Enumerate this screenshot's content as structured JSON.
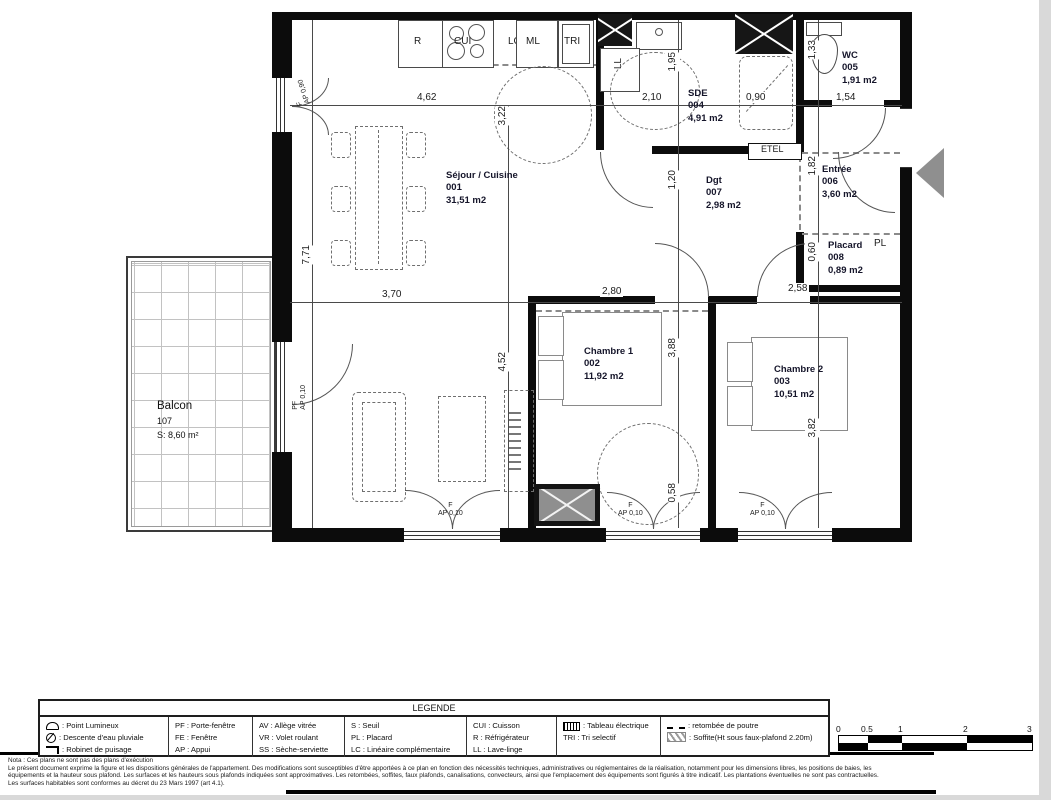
{
  "rooms": {
    "sejour": {
      "name": "Séjour / Cuisine",
      "num": "001",
      "area": "31,51 m2"
    },
    "chambre1": {
      "name": "Chambre 1",
      "num": "002",
      "area": "11,92 m2"
    },
    "chambre2": {
      "name": "Chambre 2",
      "num": "003",
      "area": "10,51 m2"
    },
    "sde": {
      "name": "SDE",
      "num": "004",
      "area": "4,91 m2"
    },
    "wc": {
      "name": "WC",
      "num": "005",
      "area": "1,91 m2"
    },
    "entree": {
      "name": "Entrée",
      "num": "006",
      "area": "3,60 m2"
    },
    "dgt": {
      "name": "Dgt",
      "num": "007",
      "area": "2,98 m2"
    },
    "placard": {
      "name": "Placard",
      "num": "008",
      "area": "0,89 m2"
    },
    "balcon": {
      "name": "Balcon",
      "num": "107",
      "area": "S: 8,60 m²"
    }
  },
  "appliances": {
    "r": "R",
    "cui": "CUI",
    "lc": "LC",
    "ml": "ML",
    "tri": "TRI",
    "ll": "LL"
  },
  "labels": {
    "etel": "ETEL",
    "pl": "PL"
  },
  "openings": {
    "f": "F",
    "pf": "PF",
    "ap010": "AP 0,10",
    "ap090": "AP 0,90"
  },
  "dims": {
    "sej_w_top": "4,62",
    "sej_h_top": "3,22",
    "left_h": "7,71",
    "sej_w_bot": "3,70",
    "sej_h_bot": "4,52",
    "sde_w": "2,10",
    "sde_h": "1,95",
    "shower_w": "0,90",
    "wc_h": "1,33",
    "wc_w": "1,54",
    "dgt_h": "1,20",
    "entree_h": "1,82",
    "placard_h": "0,60",
    "ch1_w": "2,80",
    "ch1_h": "3,88",
    "ch2_w": "2,58",
    "ch2_h": "3,82",
    "win_h": "0,58"
  },
  "legend": {
    "title": "LEGENDE",
    "col1": [
      {
        "text": ": Point Lumineux"
      },
      {
        "text": ": Descente d'eau pluviale"
      },
      {
        "text": ": Robinet de puisage"
      }
    ],
    "col2": [
      "PF : Porte-fenêtre",
      "FE : Fenêtre",
      "AP : Appui"
    ],
    "col3": [
      "AV : Allège vitrée",
      "VR : Volet roulant",
      "SS : Sèche-serviette"
    ],
    "col4": [
      "S   : Seuil",
      "PL : Placard",
      "LC : Linéaire complémentaire"
    ],
    "col5": [
      "CUI : Cuisson",
      "R    : Réfrigérateur",
      "LL   : Lave-linge"
    ],
    "col6": [
      {
        "text": ": Tableau électrique"
      },
      {
        "plain": "TRI : Tri selectif"
      }
    ],
    "col7": [
      {
        "text": ": retombée de poutre"
      },
      {
        "text": ": Soffite(Ht sous faux-plafond 2.20m)"
      }
    ]
  },
  "scale": {
    "ticks": [
      "0",
      "0.5",
      "1",
      "2",
      "3"
    ]
  },
  "notes": [
    "Nota : Ces plans ne sont pas des plans d'exécution",
    "Le présent document exprime la figure et les dispositions générales de l'appartement. Des modifications sont susceptibles d'être apportées à ce plan en fonction des nécessités techniques, administratives ou réglementaires de la réalisation, notamment pour les dimensions libres, les positions de baies, les",
    "équipements et la hauteur sous plafond. Les surfaces et les hauteurs sous plafonds indiquées sont approximatives. Les retombées, soffites, faux plafonds, canalisations, convecteurs, ainsi que l'emplacement des équipements sont figurés à titre indicatif. Les plantations éventuelles ne sont pas contractuelles.",
    "Les surfaces habitables sont conformes au décret du 23 Mars 1997 (art 4.1)."
  ]
}
